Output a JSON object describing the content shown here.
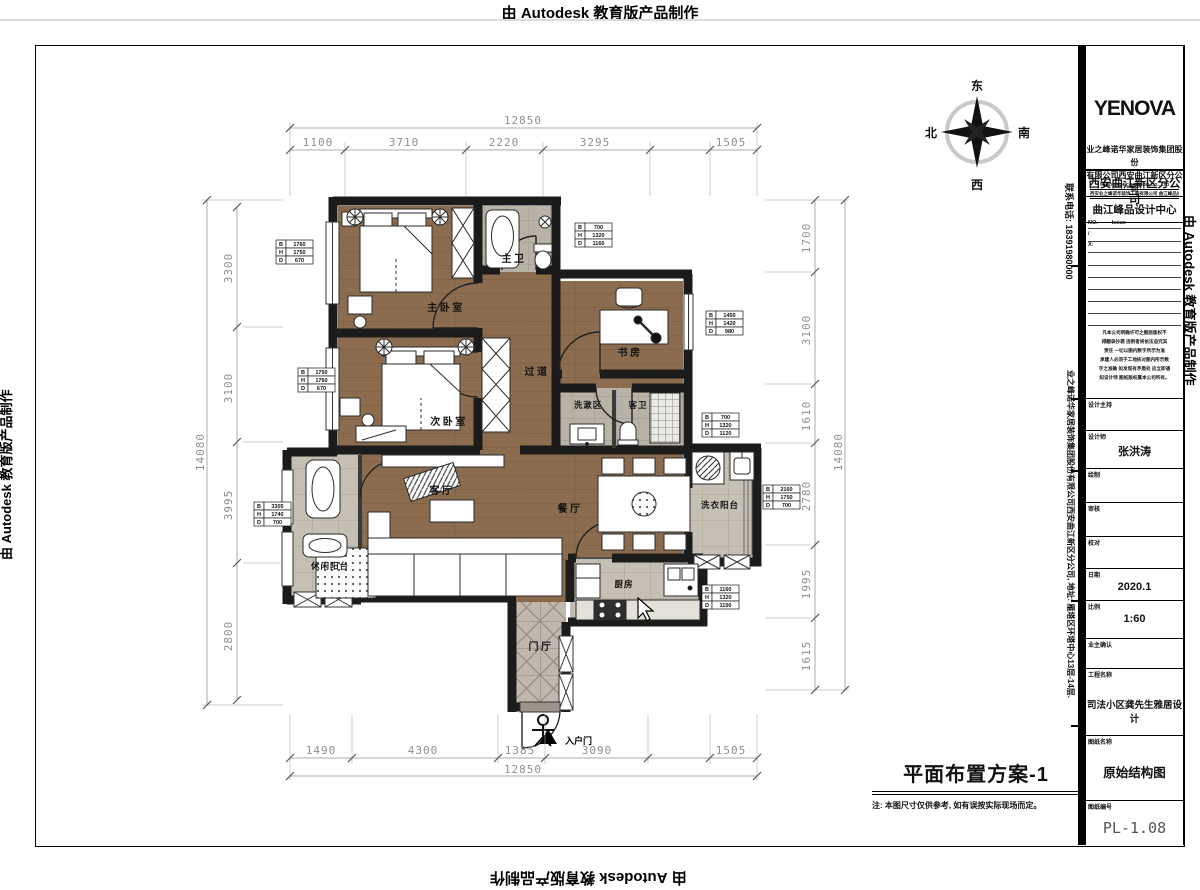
{
  "watermark": {
    "text": "由 Autodesk 教育版产品制作"
  },
  "contact": {
    "phone": "联系电话: 18391980000",
    "company": "业之峰诺华家居装饰集团股份有限公司西安曲江新区分公司, 地址: 雁塔区环塔中心13层-14层."
  },
  "compass": {
    "e": "东",
    "s": "南",
    "w": "西",
    "n": "北"
  },
  "rooms": {
    "master_bath": "主卫",
    "master_bedroom": "主卧室",
    "study": "书房",
    "hallway": "过道",
    "second_bedroom": "次卧室",
    "wash_area": "洗漱区",
    "guest_bath": "客卫",
    "living": "客厅",
    "dining": "餐厅",
    "laundry": "洗衣阳台",
    "leisure": "休闲阳台",
    "kitchen": "厨房",
    "foyer": "门厅",
    "entry": "入户门"
  },
  "dims": {
    "top_total": "12850",
    "top": [
      "1100",
      "3710",
      "2220",
      "3295",
      "1505"
    ],
    "bottom": [
      "1490",
      "4300",
      "1385",
      "3090",
      "1505"
    ],
    "bottom_total": "12850",
    "left_total": "14080",
    "left": [
      "3300",
      "3100",
      "3995",
      "2800"
    ],
    "right": [
      "1700",
      "3100",
      "1610",
      "2780",
      "1995",
      "1615"
    ],
    "right_total": "14080"
  },
  "bhd": {
    "letters": [
      "B",
      "H",
      "D"
    ],
    "boxes": [
      {
        "b": "1760",
        "h": "1750",
        "d": "670"
      },
      {
        "b": "1750",
        "h": "1760",
        "d": "670"
      },
      {
        "b": "3305",
        "h": "1740",
        "d": "700"
      },
      {
        "b": "700",
        "h": "1320",
        "d": "1160"
      },
      {
        "b": "1450",
        "h": "1420",
        "d": "980"
      },
      {
        "b": "700",
        "h": "1320",
        "d": "1120"
      },
      {
        "b": "2160",
        "h": "1750",
        "d": "700"
      },
      {
        "b": "1160",
        "h": "1320",
        "d": "1100"
      }
    ]
  },
  "footer": {
    "title": "平面布置方案-1",
    "note": "注: 本图尺寸仅供参考, 如有误按实际现场而定。"
  },
  "tb": {
    "logo": "YENOVA",
    "company1": "业之峰诺华家居装饰集团股份",
    "company2": "有限公司西安曲江新区分公司",
    "en": "YENOVA DECORATION CO., LTD",
    "en2": "西安业之峰诺华装饰工程有限公司 曲江峰品设计中心",
    "branch": "西安曲江新区分公司",
    "center": "曲江峰品设计中心",
    "no_label": "NO.",
    "issue_label": "Issue",
    "slash": "/",
    "xlabel": "X:",
    "disclaimer": [
      "凡本公司明确许可之图面版权不",
      "得翻录抄袭 违例者将依法追究其",
      "责任 一切以图内数字所示为准",
      "承建人必须于工地核对图内所示数",
      "字之准确 如发现有矛盾处 应立即通",
      "知设计师 图纸版权属本公司所有。"
    ],
    "fields": [
      {
        "label": "设计主持",
        "value": ""
      },
      {
        "label": "设计师",
        "value": "张洪涛"
      },
      {
        "label": "绘制",
        "value": ""
      },
      {
        "label": "审核",
        "value": ""
      },
      {
        "label": "校对",
        "value": ""
      },
      {
        "label": "日期",
        "value": "2020.1"
      },
      {
        "label": "比例",
        "value": "1:60"
      },
      {
        "label": "业主确认",
        "value": ""
      },
      {
        "label": "工程名称",
        "value": "司法小区龚先生雅居设计"
      },
      {
        "label": "图纸名称",
        "value": "原始结构图"
      },
      {
        "label": "图纸编号",
        "value": "PL-1.08"
      }
    ]
  }
}
